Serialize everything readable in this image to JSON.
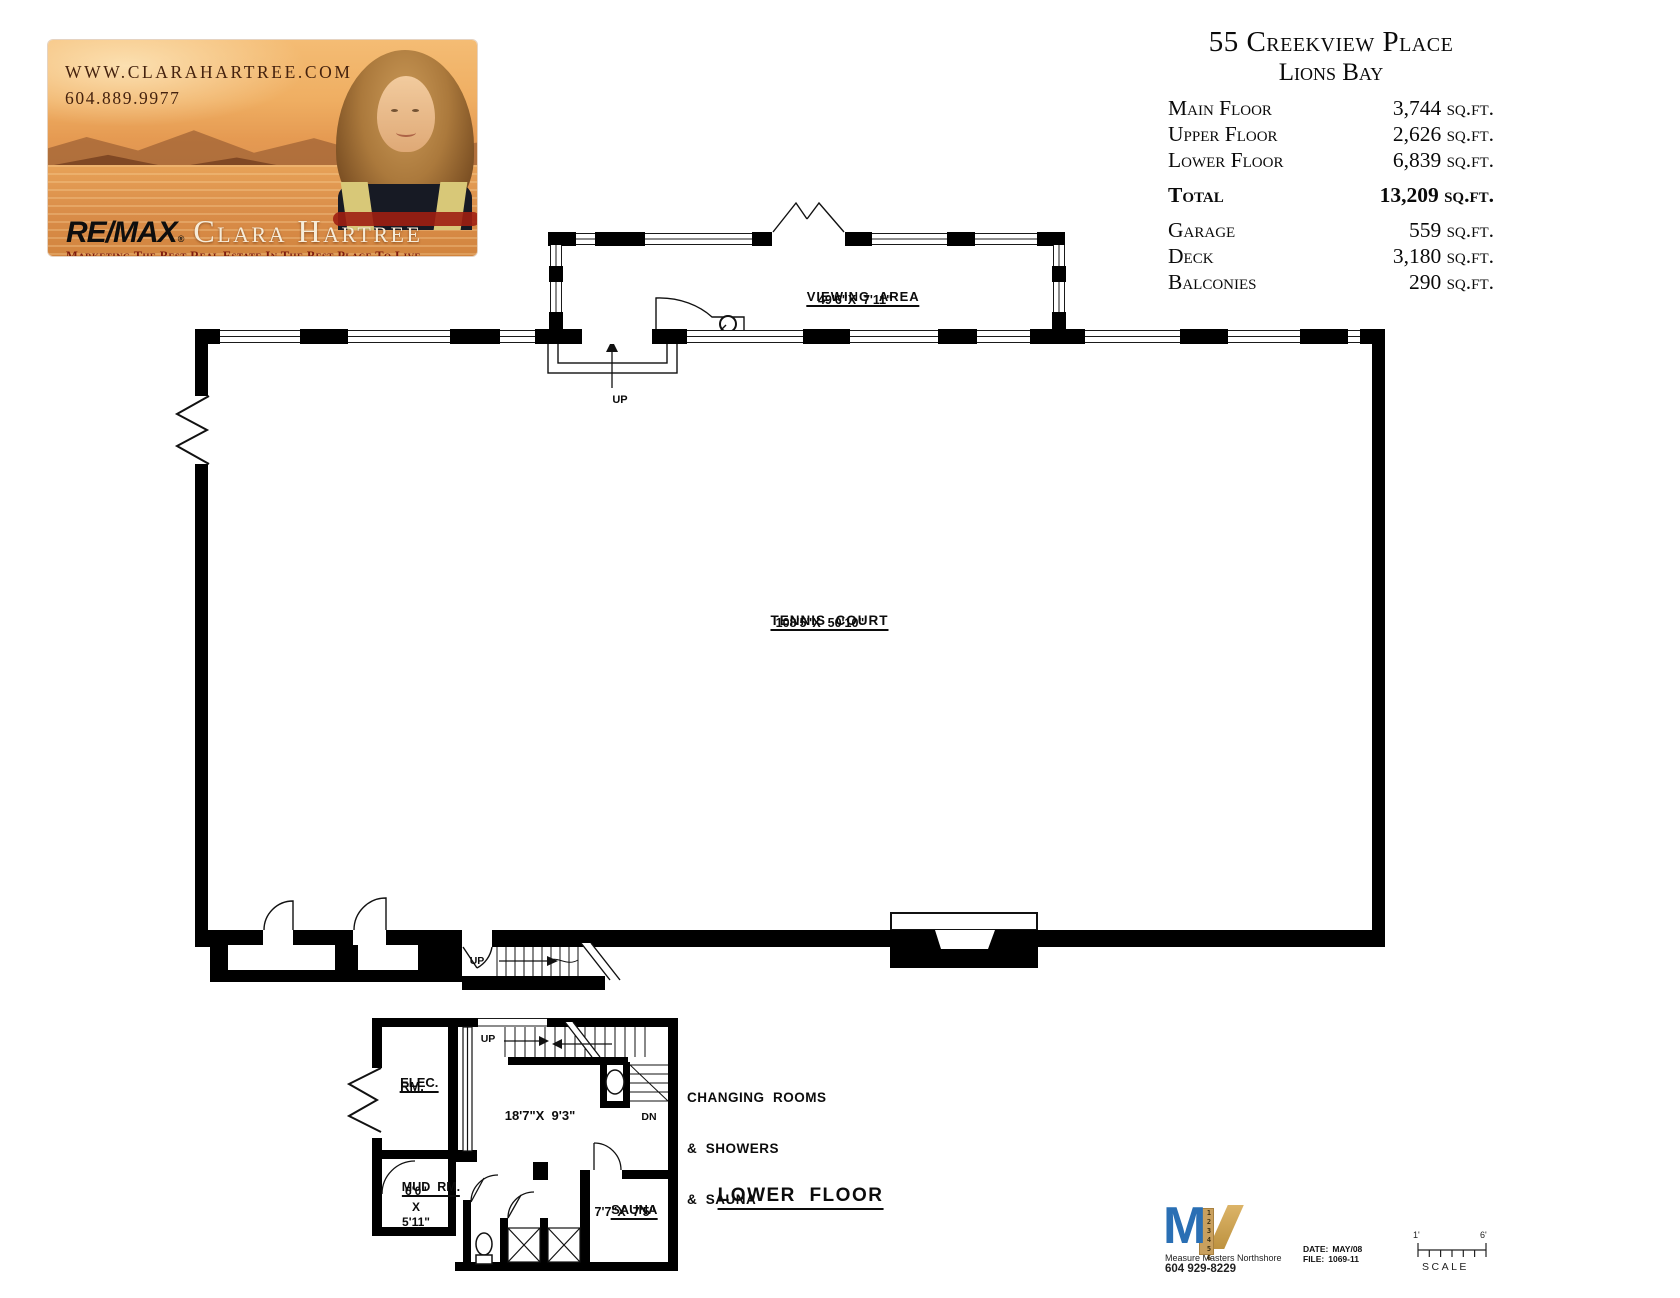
{
  "branding": {
    "website": "WWW.CLARAHARTREE.COM",
    "phone": "604.889.9977",
    "remax_wordmark": "RE/MAX",
    "registered_mark": "®",
    "agent_name": "Clara Hartree",
    "tagline": "Marketing The Best Real Estate In The Best Place To Live"
  },
  "property": {
    "address_line1": "55 Creekview Place",
    "address_line2": "Lions Bay",
    "areas": [
      {
        "label": "Main Floor",
        "value": "3,744 sq.ft."
      },
      {
        "label": "Upper Floor",
        "value": "2,626 sq.ft."
      },
      {
        "label": "Lower Floor",
        "value": "6,839 sq.ft."
      }
    ],
    "total": {
      "label": "Total",
      "value": "13,209 sq.ft."
    },
    "extras": [
      {
        "label": "Garage",
        "value": "559 sq.ft."
      },
      {
        "label": "Deck",
        "value": "3,180 sq.ft."
      },
      {
        "label": "Balconies",
        "value": "290 sq.ft."
      }
    ]
  },
  "floorplan": {
    "viewing_area_name": "VIEWING  AREA",
    "viewing_area_dims": "49'6\"X  7'11\"",
    "tennis_court_name": "TENNIS  COURT",
    "tennis_court_dims": "108'5\"X  50'10\"",
    "up_label": "UP",
    "dn_label": "DN",
    "elec_room_line1": "ELEC.",
    "elec_room_line2": "RM.",
    "changing_room_dims": "18'7\"X  9'3\"",
    "changing_line1": "CHANGING  ROOMS",
    "changing_line2": "&  SHOWERS",
    "changing_line3": "&  SAUNA",
    "mud_room_name": "MUD  RM.",
    "mud_room_dim_w": "6'0\"",
    "mud_room_dim_x": "X",
    "mud_room_dim_h": "5'11\"",
    "sauna_name": "SAUNA",
    "sauna_dims": "7'7\"X  7'5\"",
    "floor_title": "LOWER  FLOOR"
  },
  "footer": {
    "surveyor_name": "Measure Masters Northshore",
    "surveyor_phone": "604 929-8229",
    "logo_letter": "M",
    "logo_ruler_digits": "123456",
    "date_label": "DATE:",
    "date_value": "MAY/08",
    "file_label": "FILE:",
    "file_value": "1069-11",
    "scale_left": "1'",
    "scale_right": "6'",
    "scale_label": "SCALE"
  }
}
